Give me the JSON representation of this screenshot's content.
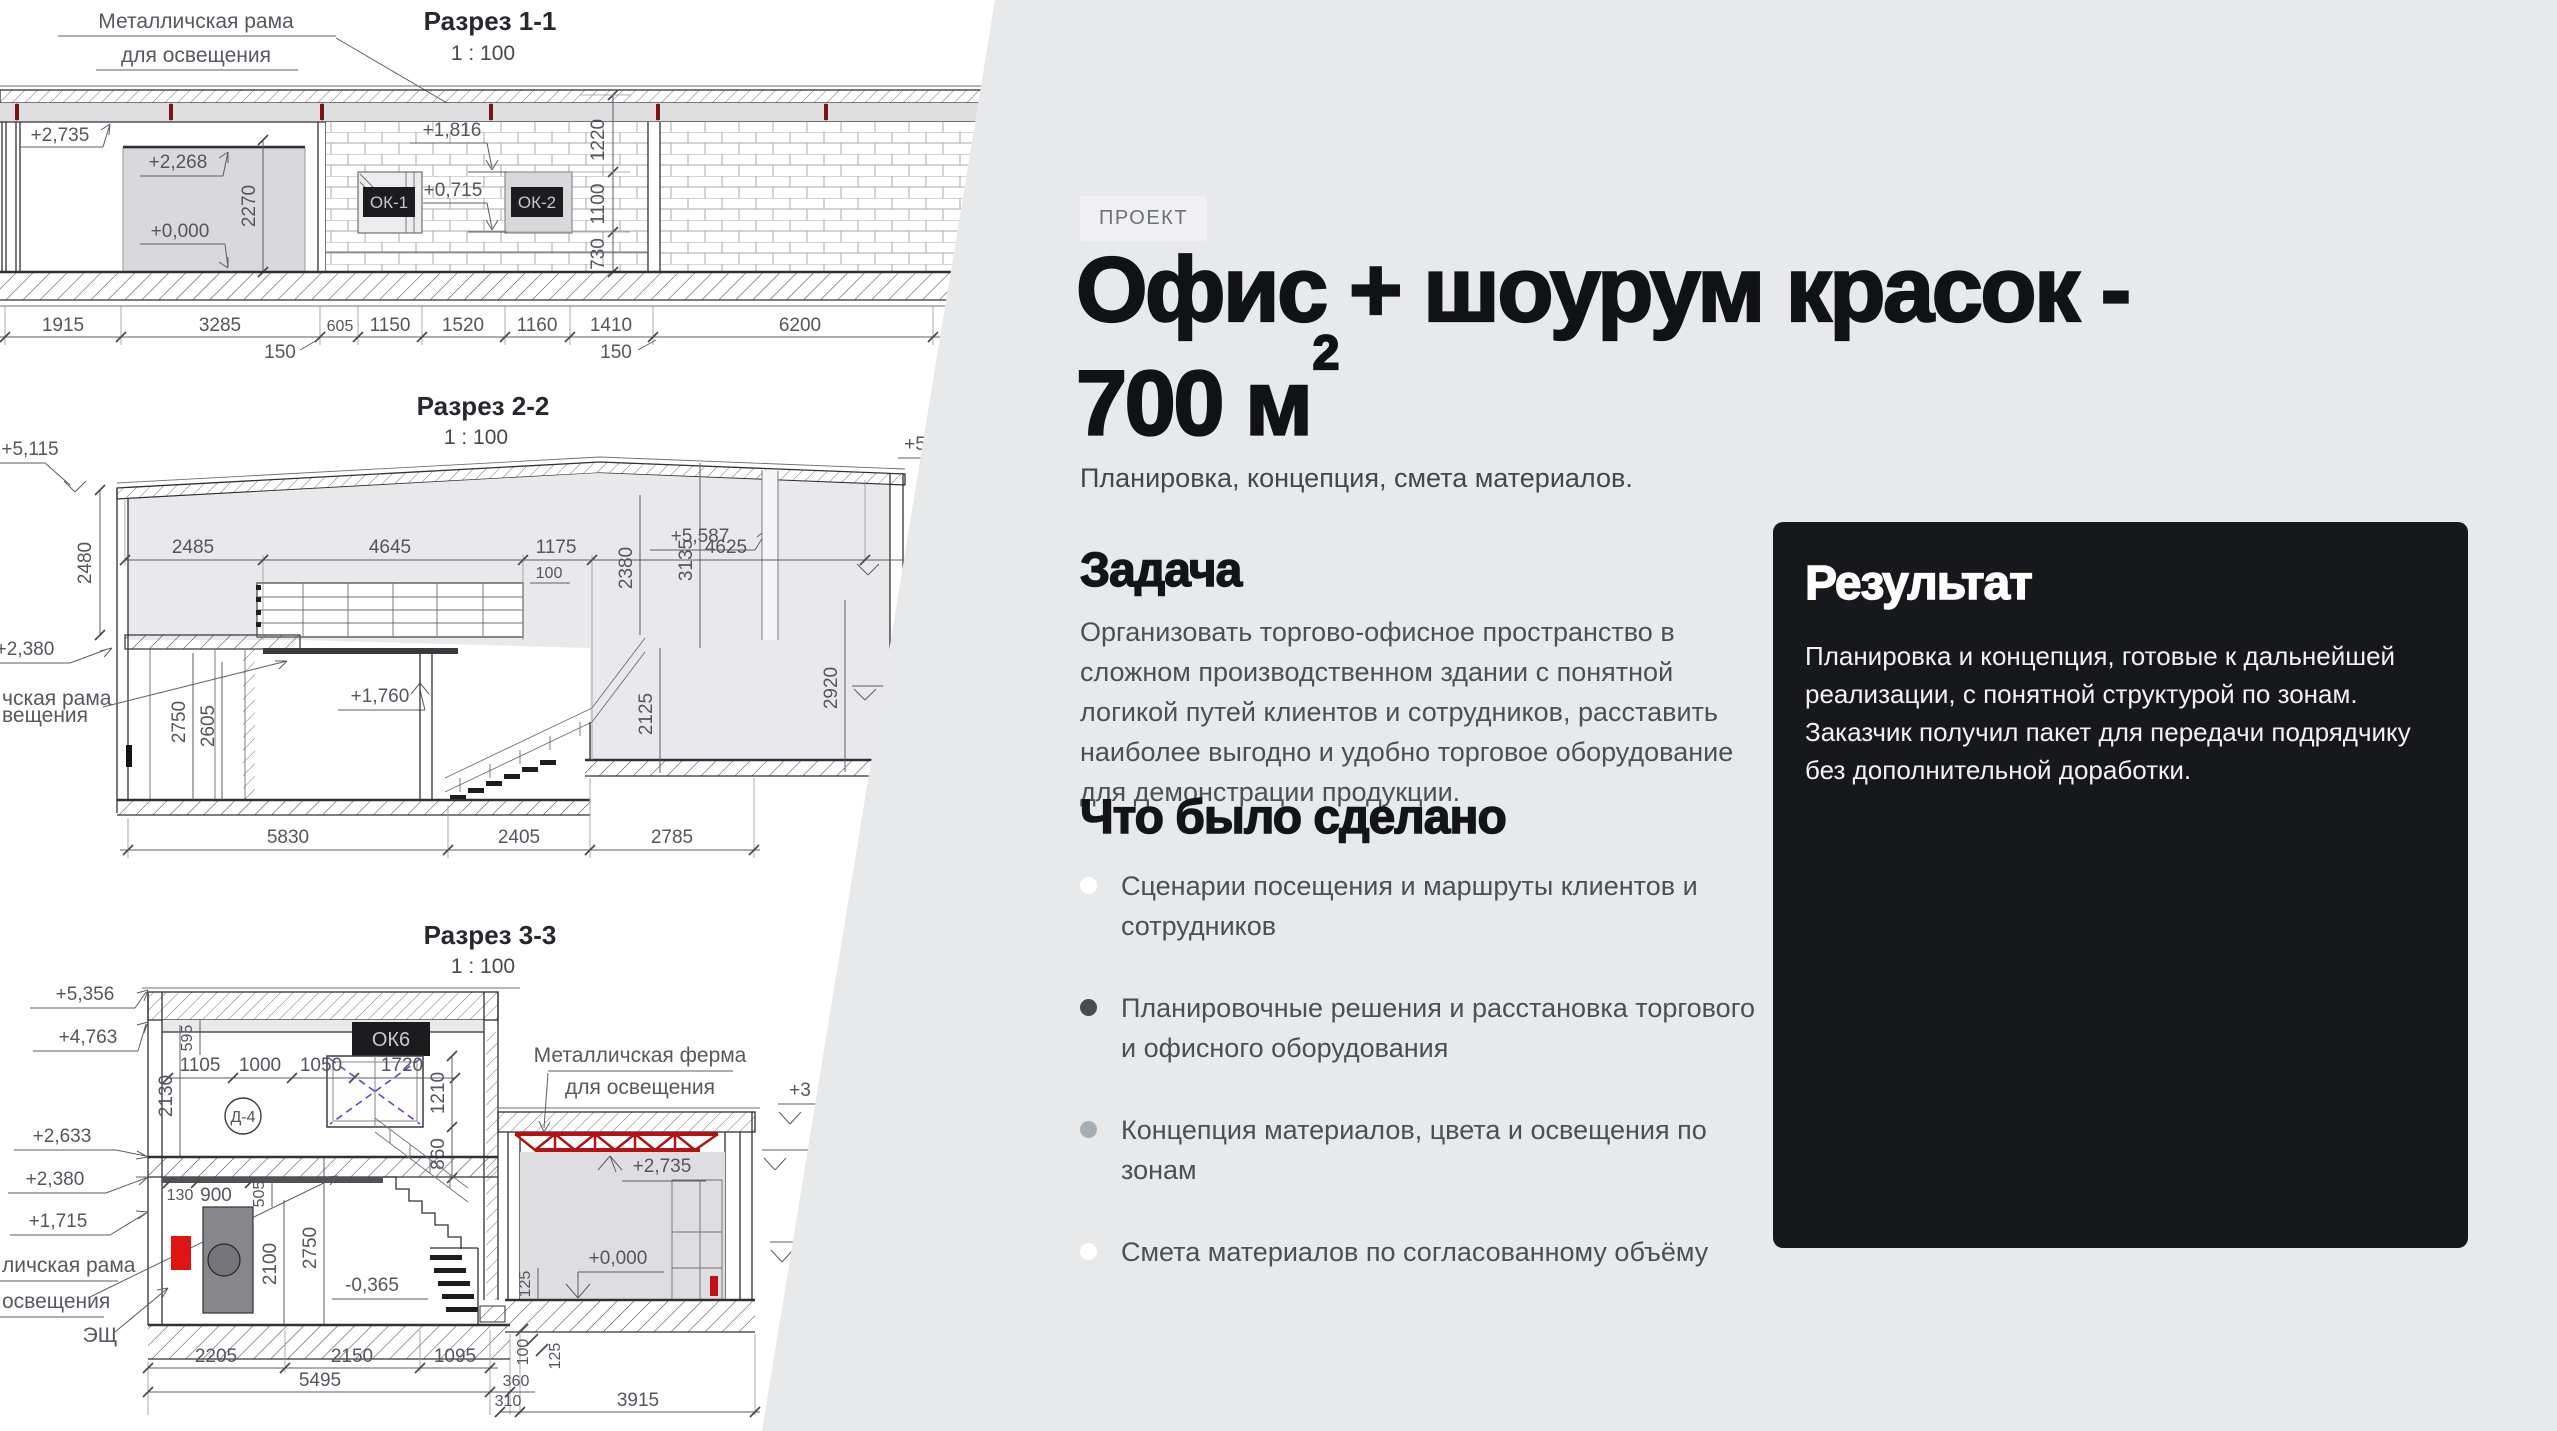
{
  "project": {
    "badge": "ПРОЕКТ",
    "title_line1": "Офис + шоурум красок -",
    "title_line2": "700 м",
    "title_sup": "2",
    "subtitle": "Планировка, концепция, смета материалов.",
    "task_heading": "Задача",
    "task_body": "Организовать торгово-офисное пространство в сложном производственном здании с понятной логикой путей клиентов и сотрудников, расставить наиболее выгодно и удобно торговое оборудование для демонстрации продукции.",
    "done_heading": "Что было сделано",
    "done_items": [
      {
        "text": "Сценарии посещения и маршруты клиентов и сотрудников",
        "dot_style": "background:#ffffff;"
      },
      {
        "text": "Планировочные решения и расстановка торгового и офисного оборудования",
        "dot_style": "background:#474c54;"
      },
      {
        "text": "Концепция материалов, цвета и освещения по зонам",
        "dot_style": "background:#a7adb5;"
      },
      {
        "text": "Смета материалов по согласованному объёму",
        "dot_style": "background:#ffffff;"
      }
    ],
    "result_heading": "Результат",
    "result_body": "Планировка и концепция, готовые к дальнейшей реализации, с понятной структурой по зонам. Заказчик получил пакет для передачи подрядчику без дополнительной доработки.",
    "colors": {
      "page_bg": "#e8e9eb",
      "card_bg": "#17181c",
      "accent_red": "#b31312"
    }
  },
  "drawings": {
    "s1": {
      "title": "Разрез 1-1",
      "scale": "1 : 100",
      "note1": "Металличская рама",
      "note2": "для освещения",
      "lv1": "+2,735",
      "lv2": "+2,268",
      "lv3": "+0,000",
      "lv4": "+1,816",
      "lv5": "+0,715",
      "win1": "ОК-1",
      "win2": "ОК-2",
      "v1": "2270",
      "v2": "1220",
      "v3": "1100",
      "v4": "730",
      "c1": "1915",
      "c2": "3285",
      "c3": "605",
      "c4": "1150",
      "c5": "1520",
      "c6": "1160",
      "c7": "1410",
      "c8": "6200",
      "s150a": "150",
      "s150b": "150"
    },
    "s2": {
      "title": "Разрез 2-2",
      "scale": "1 : 100",
      "lv1": "+5,115",
      "lv2": "+5,587",
      "lv3": "+2,380",
      "lv4": "+1,760",
      "lv5": "+5",
      "cut1": "чская рама",
      "cut2": "вещения",
      "v1": "2480",
      "v2": "2750",
      "v3": "2605",
      "v4": "2380",
      "v5": "3135",
      "v6": "2920",
      "v7": "2125",
      "h1": "2485",
      "h2": "4645",
      "h3": "1175",
      "h4": "100",
      "h5": "4625",
      "c1": "5830",
      "c2": "2405",
      "c3": "2785"
    },
    "s3": {
      "title": "Разрез 3-3",
      "scale": "1 : 100",
      "note1": "Металличская ферма",
      "note2": "для освещения",
      "lv1": "+5,356",
      "lv2": "+4,763",
      "lv3": "+2,633",
      "lv4": "+2,380",
      "lv5": "+1,715",
      "lv6": "+2,735",
      "lv7": "+0,000",
      "lv8": "-0,365",
      "lv9": "+3",
      "cut1": "личская рама",
      "cut2": "освещения",
      "esh": "ЭЩ",
      "ok6": "ОК6",
      "d4": "Д-4",
      "v1": "595",
      "v2": "2130",
      "v3": "1210",
      "v4": "860",
      "v5": "505",
      "v6": "2100",
      "v7": "2750",
      "v8": "125",
      "v9": "100",
      "v10": "125",
      "h1": "1105",
      "h2": "1000",
      "h3": "1050",
      "h4": "1720",
      "h5": "130",
      "h6": "900",
      "c1": "2205",
      "c2": "2150",
      "c3": "1095",
      "c4": "5495",
      "c5": "360",
      "c6": "310",
      "c7": "3915"
    }
  }
}
